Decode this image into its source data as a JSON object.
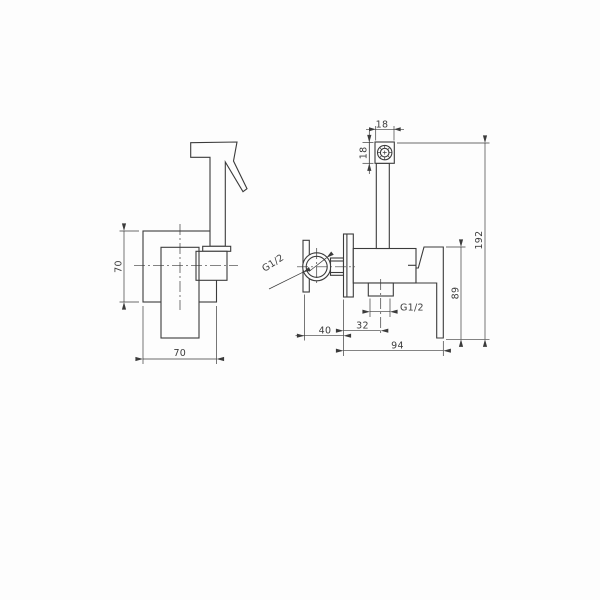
{
  "drawing": {
    "kind": "technical dimension drawing - wall mounted bidet hand shower mixer",
    "background_color": "#fdfdfd",
    "line_color": "#3b3b3b",
    "views": [
      "front view with hand spray",
      "side view with valve body"
    ]
  },
  "labels": {
    "front_height": "70",
    "front_width": "70",
    "spout_width": "18",
    "spout_height": "18",
    "overall_height": "192",
    "handle_length": "89",
    "inlet_offset": "40",
    "outlet_offset": "32",
    "overall_depth": "94",
    "inlet_thread": "G1/2",
    "outlet_thread": "G1/2"
  }
}
